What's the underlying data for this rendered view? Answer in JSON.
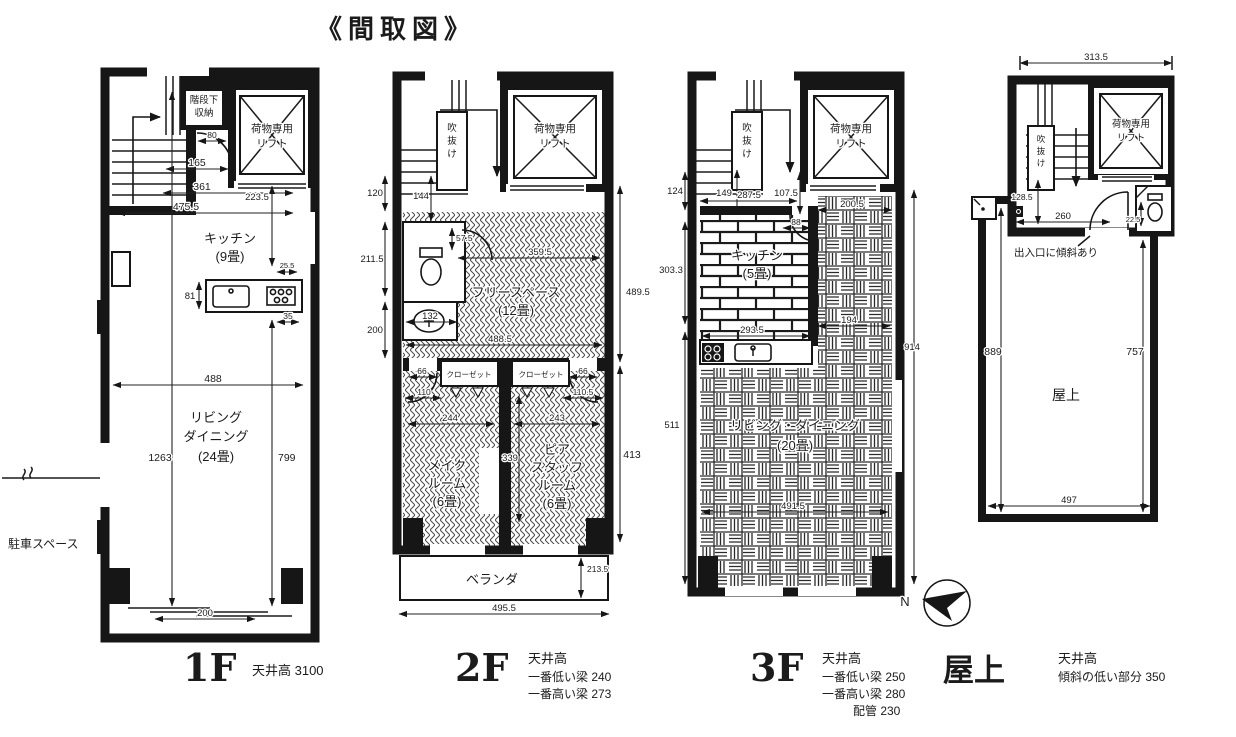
{
  "title": "《間取図》",
  "common": {
    "lift1": "荷物専用",
    "lift2": "リフト",
    "void1": "吹",
    "void2": "抜",
    "void3": "け",
    "closet": "クローゼット",
    "north": "N"
  },
  "f1": {
    "label": "1F",
    "ceiling": "天井高 3100",
    "storage1": "階段下",
    "storage2": "収納",
    "kitchen": "キッチン",
    "kitchen_size": "(9畳)",
    "living1": "リビング",
    "living2": "ダイニング",
    "living_size": "(24畳)",
    "parking": "駐車スペース",
    "dims": {
      "d80": "80",
      "d165": "165",
      "d361": "361",
      "d223_5": "223.5",
      "d475_5": "475.5",
      "d25_5": "25.5",
      "d81": "81",
      "d35": "35",
      "d488": "488",
      "d1263": "1263",
      "d799": "799",
      "d200": "200"
    }
  },
  "f2": {
    "label": "2F",
    "ceil_title": "天井高",
    "ceil1": "一番低い梁 240",
    "ceil2": "一番高い梁 273",
    "free": "フリースペース",
    "free_size": "(12畳)",
    "make1": "メイク",
    "make2": "ルーム",
    "make_size": "(6畳)",
    "staff1": "ピア",
    "staff2": "スタッフ",
    "staff3": "ルーム",
    "staff_size": "(6畳)",
    "veranda": "ベランダ",
    "dims": {
      "d120": "120",
      "d211_5": "211.5",
      "d200": "200",
      "d144": "144",
      "d57_5": "57.5",
      "d359_5": "359.5",
      "d132": "132",
      "d488_5": "488.5",
      "d66l": "66",
      "d66r": "66",
      "d110": "110",
      "d110_5": "110.5",
      "d244": "244",
      "d243": "243",
      "d339": "339",
      "d413": "413",
      "d489_5": "489.5",
      "d213_5": "213.5",
      "d495_5": "495.5"
    }
  },
  "f3": {
    "label": "3F",
    "ceil_title": "天井高",
    "ceil1": "一番低い梁 250",
    "ceil2": "一番高い梁 280",
    "ceil3": "配管 230",
    "kitchen": "キッチン",
    "kitchen_size": "(5畳)",
    "living": "リビング・ダイニング",
    "living_size": "(20畳)",
    "dims": {
      "d124": "124",
      "d303_3": "303.3",
      "d511": "511",
      "d149": "149",
      "d287_5": "287.5",
      "d107_5": "107.5",
      "d88": "88",
      "d200_5": "200.5",
      "d194": "194",
      "d293_5": "293.5",
      "d914": "914",
      "d491_5": "491.5"
    }
  },
  "roof": {
    "label": "屋上",
    "name": "屋上",
    "ceil_title": "天井高",
    "ceil1": "傾斜の低い部分 350",
    "slope_note": "出入口に傾斜あり",
    "dims": {
      "d313_5": "313.5",
      "d128_5": "128.5",
      "d260": "260",
      "d22_5": "22.5",
      "d889": "889",
      "d757": "757",
      "d497": "497"
    }
  }
}
